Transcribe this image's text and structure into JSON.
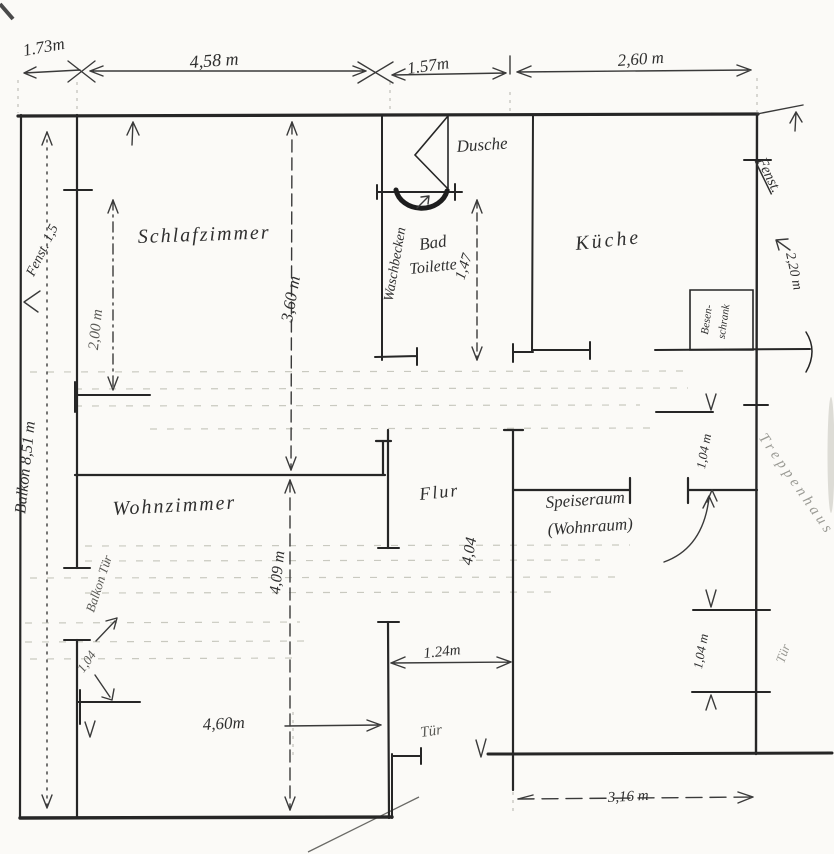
{
  "rooms": {
    "schlafzimmer": "Schlafzimmer",
    "wohnzimmer": "Wohnzimmer",
    "flur": "Flur",
    "kueche": "Küche",
    "bad_line1": "Bad",
    "bad_line2": "Toilette",
    "dusche": "Dusche",
    "waschbecken": "Waschbecken",
    "speiseraum_line1": "Speiseraum",
    "speiseraum_line2": "(Wohnraum)",
    "besenschrank_line1": "Besen-",
    "besenschrank_line2": "schrank",
    "balkon": "Balkon 8,51 m",
    "treppenhaus": "Treppenhaus"
  },
  "doors_windows": {
    "balkon_tuer": "Balkon Tür",
    "tuer_flur": "Tür",
    "tuer_treppenhaus": "Tür",
    "fenster_left": "Fenst. 1,5",
    "fenster_right": "Fenst.",
    "fenster_right_size": "2,20 m"
  },
  "dimensions": {
    "balkon_breite": "1.73m",
    "schlafzimmer_breite": "4,58 m",
    "bad_breite": "1.57m",
    "kueche_breite": "2,60 m",
    "schlafzimmer_tiefe": "3,60 m",
    "schlafzimmer_innen": "2,00 m",
    "bad_tiefe": "1,47",
    "wohnzimmer_tiefe": "4,09 m",
    "wohnzimmer_breite": "4,60m",
    "flur_breite": "1.24m",
    "flur_tiefe": "4,04",
    "fenster_oben": "1,04 m",
    "tuer_unten": "1,04 m",
    "wohnzimmer_tuer": "1,04",
    "speiseraum_breite": "3,16 m"
  }
}
